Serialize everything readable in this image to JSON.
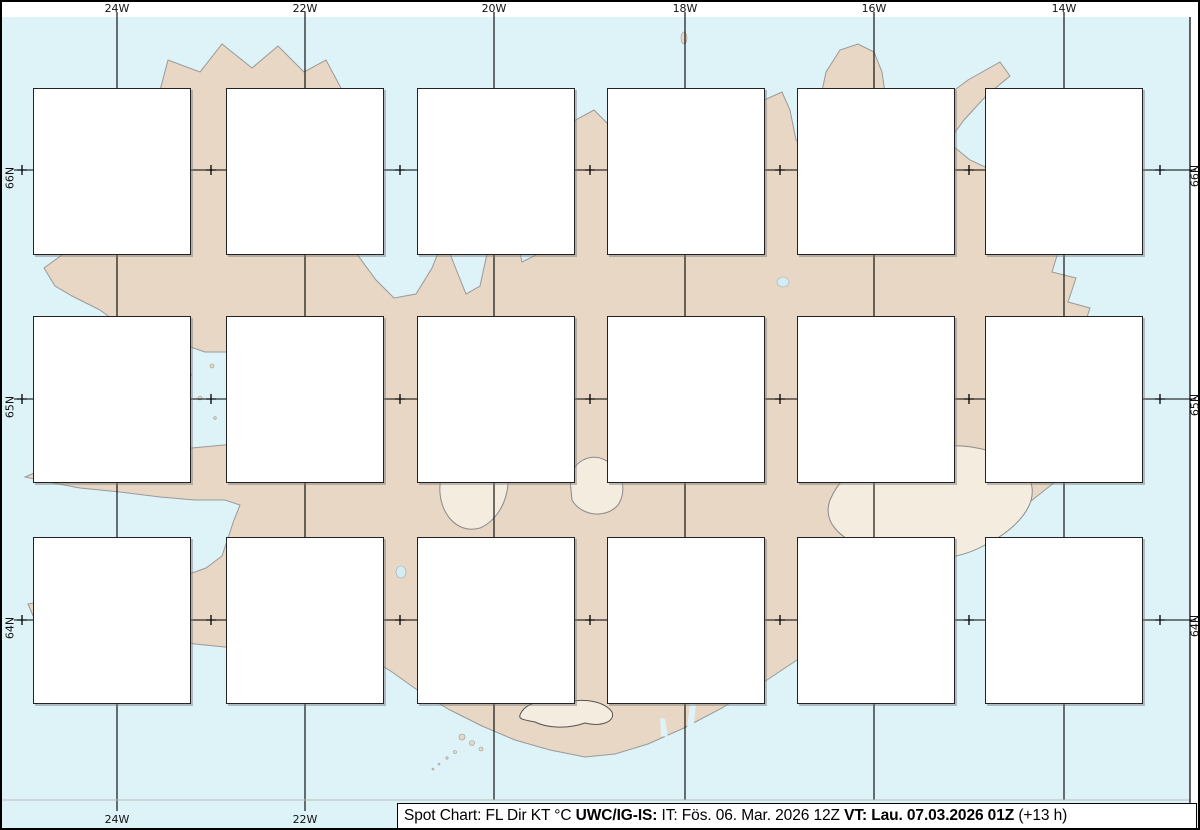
{
  "title_note": "Spot chart of flight-level wind and temperature over Iceland",
  "colors": {
    "ocean": "#ddf3f8",
    "land": "#e8d7c4",
    "coast": "#999999",
    "temp_negative": "#0000ee",
    "temp_positive": "#ee0000",
    "temp_zero": "#000000",
    "speed_high": "#ffa500",
    "grid": "#000000",
    "box_border": "#222222"
  },
  "axis": {
    "top_labels": [
      "24W",
      "22W",
      "20W",
      "18W",
      "16W",
      "14W"
    ],
    "bottom_labels": [
      "24W",
      "22W"
    ],
    "lat_labels": [
      "66N",
      "65N",
      "64N"
    ]
  },
  "legend": "FL Dir KT °C",
  "stations": [
    {
      "row": 0,
      "col": 0,
      "lines": [
        [
          "240",
          "180",
          "41",
          "-49"
        ],
        [
          "180",
          "180",
          "43",
          "-35"
        ],
        [
          "140",
          "170",
          "32",
          "-24"
        ],
        [
          "100",
          "170",
          "33",
          "-15"
        ],
        [
          "060",
          "170",
          "47",
          "-07"
        ],
        [
          "050",
          "170",
          "52",
          "-04"
        ],
        [
          "030",
          "160",
          "49",
          "-01"
        ],
        [
          "020",
          "150",
          "48",
          "00"
        ],
        [
          "020",
          "140",
          "39",
          "+01"
        ]
      ]
    },
    {
      "row": 0,
      "col": 1,
      "lines": [
        [
          "240",
          "190",
          "40",
          "-49"
        ],
        [
          "180",
          "190",
          "32",
          "-36"
        ],
        [
          "140",
          "200",
          "35",
          "-24"
        ],
        [
          "100",
          "200",
          "38",
          "-15"
        ],
        [
          "060",
          "180",
          "48",
          "-08"
        ],
        [
          "050",
          "170",
          "51",
          "-06"
        ],
        [
          "030",
          "150",
          "33",
          "-04"
        ],
        [
          "020",
          "150",
          "22",
          "-03"
        ],
        [
          "020",
          "150",
          "22",
          "-01"
        ]
      ]
    },
    {
      "row": 0,
      "col": 2,
      "lines": [
        [
          "240",
          "180",
          "33",
          "-45"
        ],
        [
          "180",
          "210",
          "50",
          "-36"
        ],
        [
          "140",
          "220",
          "43",
          "-25"
        ],
        [
          "100",
          "200",
          "36",
          "-16"
        ],
        [
          "060",
          "200",
          "42",
          "-07"
        ],
        [
          "050",
          "190",
          "50",
          "-03"
        ],
        [
          "030",
          "180",
          "57",
          "00"
        ],
        [
          "020",
          "180",
          "51",
          "00"
        ],
        [
          "020",
          "170",
          "34",
          "00"
        ]
      ]
    },
    {
      "row": 0,
      "col": 3,
      "lines": [
        [
          "240",
          "180",
          "56",
          "-41"
        ],
        [
          "180",
          "230",
          "34",
          "-35"
        ],
        [
          "140",
          "240",
          "33",
          "-25"
        ],
        [
          "100",
          "230",
          "41",
          "-16"
        ],
        [
          "060",
          "200",
          "50",
          "-10"
        ],
        [
          "050",
          "190",
          "44",
          "-06"
        ],
        [
          "030",
          "170",
          "29",
          "-04"
        ],
        [
          "020",
          "170",
          "24",
          "-02"
        ],
        [
          "020",
          "170",
          "26",
          "-01"
        ]
      ]
    },
    {
      "row": 0,
      "col": 4,
      "lines": [
        [
          "240",
          "180",
          "88",
          "-39"
        ],
        [
          "180",
          "170",
          "78",
          "-30"
        ],
        [
          "140",
          "190",
          "52",
          "-25"
        ],
        [
          "100",
          "190",
          "50",
          "-17"
        ],
        [
          "060",
          "200",
          "50",
          "-09"
        ],
        [
          "050",
          "200",
          "38",
          "-06"
        ],
        [
          "030",
          "200",
          "29",
          "-03"
        ],
        [
          "020",
          "200",
          "22",
          "-01"
        ],
        [
          "020",
          "200",
          "17",
          "00"
        ]
      ]
    },
    {
      "row": 0,
      "col": 5,
      "lines": [
        [
          "240",
          "190",
          "86",
          "-40"
        ],
        [
          "180",
          "180",
          "85",
          "-29"
        ],
        [
          "140",
          "180",
          "77",
          "-20"
        ],
        [
          "100",
          "170",
          "72",
          "-13"
        ],
        [
          "060",
          "190",
          "60",
          "-07"
        ],
        [
          "050",
          "200",
          "57",
          "-05"
        ],
        [
          "030",
          "200",
          "46",
          "-01"
        ],
        [
          "020",
          "200",
          "43",
          "+01"
        ],
        [
          "020",
          "200",
          "40",
          "+03"
        ]
      ]
    },
    {
      "row": 1,
      "col": 0,
      "lines": [
        [
          "240",
          "180",
          "40",
          "-49"
        ],
        [
          "180",
          "180",
          "52",
          "-35"
        ],
        [
          "140",
          "190",
          "44",
          "-25"
        ],
        [
          "100",
          "190",
          "49",
          "-15"
        ],
        [
          "060",
          "190",
          "54",
          "-07"
        ],
        [
          "050",
          "190",
          "47",
          "-04"
        ],
        [
          "030",
          "180",
          "45",
          "00"
        ],
        [
          "020",
          "170",
          "41",
          "+01"
        ],
        [
          "020",
          "160",
          "30",
          "+02"
        ]
      ]
    },
    {
      "row": 1,
      "col": 1,
      "lines": [
        [
          "240",
          "190",
          "49",
          "-49"
        ],
        [
          "180",
          "210",
          "47",
          "-36"
        ],
        [
          "140",
          "210",
          "54",
          "-25"
        ],
        [
          "100",
          "210",
          "42",
          "-15"
        ],
        [
          "060",
          "210",
          "39",
          "-07"
        ],
        [
          "050",
          "200",
          "43",
          "-04"
        ],
        [
          "030",
          "190",
          "49",
          "-01"
        ],
        [
          "020",
          "190",
          "45",
          "00"
        ],
        [
          "020",
          "180",
          "33",
          "+02"
        ]
      ]
    },
    {
      "row": 1,
      "col": 2,
      "lines": [
        [
          "240",
          "210",
          "40",
          "-48"
        ],
        [
          "180",
          "200",
          "42",
          "-36"
        ],
        [
          "140",
          "200",
          "53",
          "-25"
        ],
        [
          "100",
          "200",
          "49",
          "-15"
        ],
        [
          "060",
          "180",
          "65",
          "-08"
        ],
        [
          "050",
          "170",
          "54",
          "-05"
        ],
        [
          "030",
          "160",
          "33",
          "-03"
        ],
        [
          "020",
          "160",
          "33",
          "-01"
        ],
        [
          "020",
          "160",
          "33",
          "00"
        ]
      ]
    },
    {
      "row": 1,
      "col": 3,
      "lines": [
        [
          "240",
          "200",
          "40",
          "-43"
        ],
        [
          "180",
          "230",
          "37",
          "-36"
        ],
        [
          "140",
          "220",
          "42",
          "-24"
        ],
        [
          "100",
          "210",
          "56",
          "-16"
        ],
        [
          "060",
          "210",
          "55",
          "-09"
        ],
        [
          "050",
          "190",
          "62",
          "-06"
        ],
        [
          "030",
          "190",
          "43",
          "-03"
        ],
        [
          "020",
          "190",
          "43",
          "-02"
        ],
        [
          "020",
          "190",
          "43",
          "-01"
        ]
      ]
    },
    {
      "row": 1,
      "col": 4,
      "lines": [
        [
          "240",
          "190",
          "89",
          "-39"
        ],
        [
          "180",
          "200",
          "58",
          "-35"
        ],
        [
          "140",
          "230",
          "43",
          "-27"
        ],
        [
          "100",
          "210",
          "49",
          "-16"
        ],
        [
          "060",
          "210",
          "56",
          "-08"
        ],
        [
          "050",
          "200",
          "56",
          "-05"
        ],
        [
          "030",
          "190",
          "30",
          "-04"
        ],
        [
          "020",
          "190",
          "27",
          "-02"
        ],
        [
          "020",
          "190",
          "27",
          "-01"
        ]
      ]
    },
    {
      "row": 1,
      "col": 5,
      "lines": [
        [
          "240",
          "190",
          "100",
          "-39"
        ],
        [
          "180",
          "190",
          "97",
          "-29"
        ],
        [
          "140",
          "190",
          "88",
          "-21"
        ],
        [
          "100",
          "200",
          "61",
          "-18"
        ],
        [
          "060",
          "210",
          "52",
          "-10"
        ],
        [
          "050",
          "210",
          "50",
          "-06"
        ],
        [
          "030",
          "210",
          "45",
          "-02"
        ],
        [
          "020",
          "200",
          "36",
          "-01"
        ],
        [
          "020",
          "200",
          "32",
          "+01"
        ]
      ]
    },
    {
      "row": 2,
      "col": 0,
      "lines": [
        [
          "240",
          "180",
          "44",
          "-49"
        ],
        [
          "180",
          "190",
          "48",
          "-36"
        ],
        [
          "140",
          "200",
          "57",
          "-25"
        ],
        [
          "100",
          "210",
          "59",
          "-15"
        ],
        [
          "060",
          "210",
          "62",
          "-08"
        ],
        [
          "050",
          "200",
          "64",
          "-04"
        ],
        [
          "030",
          "200",
          "55",
          "-01"
        ],
        [
          "020",
          "200",
          "50",
          "+01"
        ],
        [
          "020",
          "210",
          "44",
          "+03"
        ]
      ]
    },
    {
      "row": 2,
      "col": 1,
      "lines": [
        [
          "240",
          "190",
          "56",
          "-49"
        ],
        [
          "180",
          "190",
          "44",
          "-36"
        ],
        [
          "140",
          "210",
          "52",
          "-26"
        ],
        [
          "100",
          "210",
          "49",
          "-16"
        ],
        [
          "060",
          "210",
          "59",
          "-08"
        ],
        [
          "050",
          "210",
          "57",
          "-04"
        ],
        [
          "030",
          "200",
          "53",
          "-01"
        ],
        [
          "020",
          "190",
          "51",
          "+01"
        ],
        [
          "020",
          "190",
          "42",
          "+03"
        ]
      ]
    },
    {
      "row": 2,
      "col": 2,
      "lines": [
        [
          "240",
          "190",
          "54",
          "-50"
        ],
        [
          "180",
          "210",
          "39",
          "-36"
        ],
        [
          "140",
          "210",
          "51",
          "-26"
        ],
        [
          "100",
          "220",
          "53",
          "-16"
        ],
        [
          "060",
          "210",
          "49",
          "-08"
        ],
        [
          "050",
          "200",
          "44",
          "-05"
        ],
        [
          "030",
          "190",
          "39",
          "-02"
        ],
        [
          "020",
          "180",
          "35",
          "00"
        ],
        [
          "020",
          "180",
          "26",
          "00"
        ]
      ]
    },
    {
      "row": 2,
      "col": 3,
      "lines": [
        [
          "240",
          "220",
          "40",
          "-48"
        ],
        [
          "180",
          "220",
          "48",
          "-37"
        ],
        [
          "140",
          "210",
          "49",
          "-26"
        ],
        [
          "100",
          "200",
          "44",
          "-17"
        ],
        [
          "060",
          "190",
          "50",
          "-09"
        ],
        [
          "050",
          "190",
          "48",
          "-06"
        ],
        [
          "030",
          "180",
          "37",
          "-02"
        ],
        [
          "020",
          "170",
          "24",
          "-01"
        ],
        [
          "020",
          "170",
          "23",
          "00"
        ]
      ]
    },
    {
      "row": 2,
      "col": 4,
      "lines": [
        [
          "240",
          "200",
          "95",
          "-40"
        ],
        [
          "180",
          "210",
          "41",
          "-36"
        ],
        [
          "140",
          "240",
          "31",
          "-27"
        ],
        [
          "100",
          "220",
          "47",
          "-18"
        ],
        [
          "060",
          "210",
          "50",
          "-10"
        ],
        [
          "050",
          "210",
          "48",
          "-06"
        ],
        [
          "030",
          "210",
          "43",
          "-02"
        ],
        [
          "020",
          "210",
          "40",
          "00"
        ],
        [
          "020",
          "210",
          "36",
          "+02"
        ]
      ]
    },
    {
      "row": 2,
      "col": 5,
      "lines": [
        [
          "240",
          "200",
          "109",
          "-40"
        ],
        [
          "180",
          "200",
          "103",
          "-29"
        ],
        [
          "140",
          "200",
          "83",
          "-23"
        ],
        [
          "100",
          "210",
          "49",
          "-19"
        ],
        [
          "060",
          "210",
          "54",
          "-11"
        ],
        [
          "050",
          "210",
          "55",
          "-06"
        ],
        [
          "030",
          "210",
          "54",
          "-02"
        ],
        [
          "020",
          "210",
          "52",
          "00"
        ],
        [
          "020",
          "210",
          "50",
          "+02"
        ]
      ]
    }
  ],
  "caption": {
    "segments": [
      {
        "text": "Spot Chart: FL Dir KT °C ",
        "bold": false
      },
      {
        "text": "UWC/IG-IS:",
        "bold": true
      },
      {
        "text": " IT: Fös. 06. Mar. 2026 12Z ",
        "bold": false
      },
      {
        "text": "VT: Lau. 07.03.2026 01Z",
        "bold": true
      },
      {
        "text": " (+13 h)",
        "bold": false
      }
    ]
  }
}
